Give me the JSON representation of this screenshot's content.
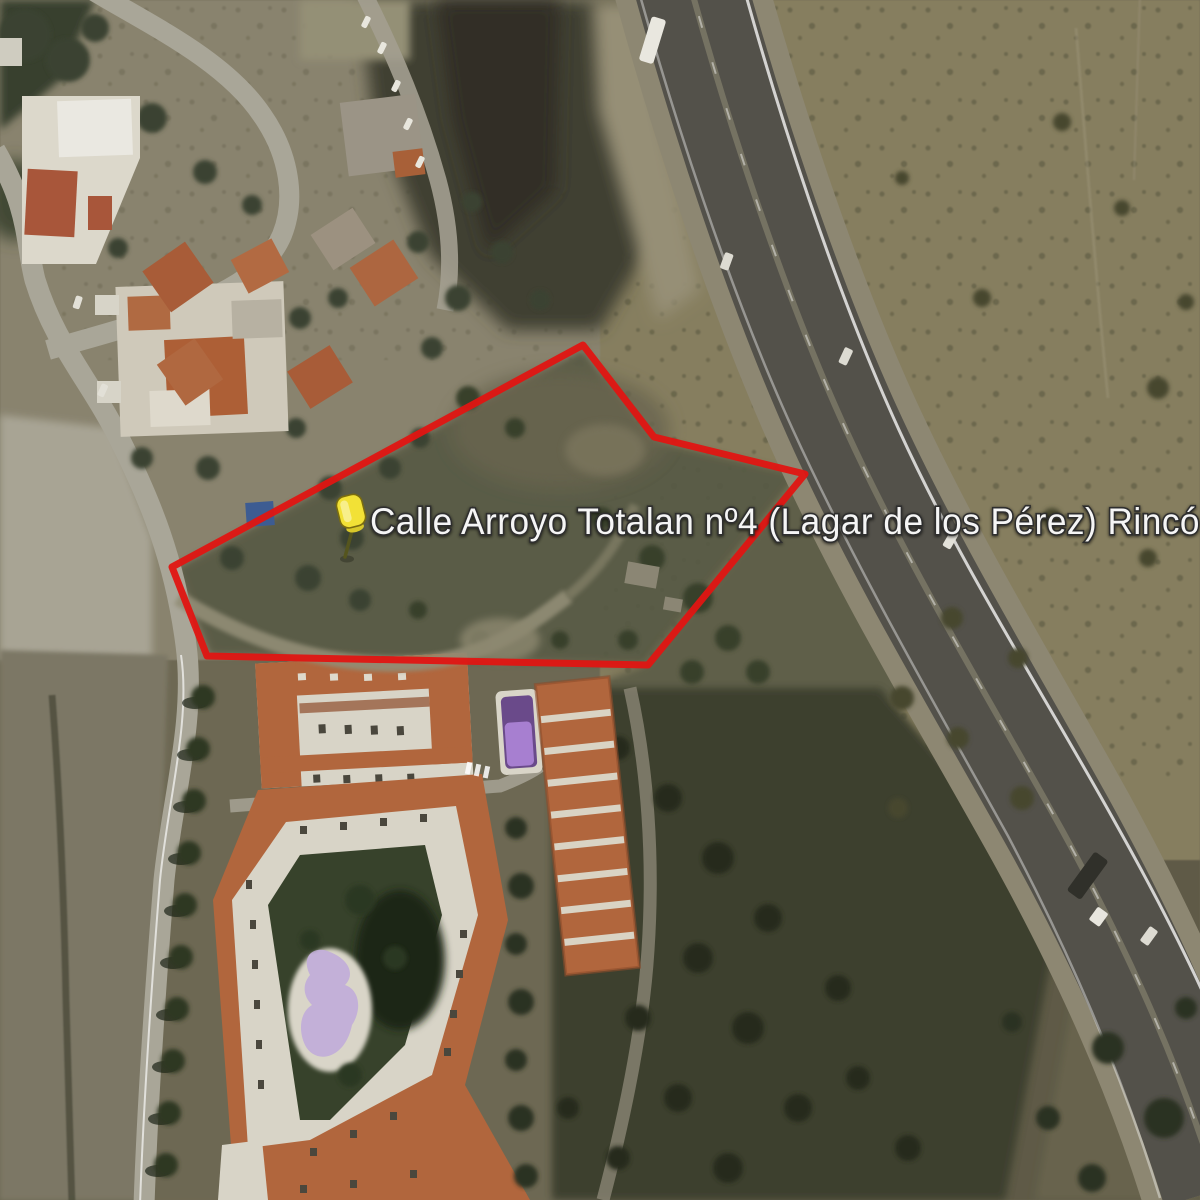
{
  "view": {
    "type": "satellite-imagery",
    "width_px": 1200,
    "height_px": 1200
  },
  "place_label": {
    "text": "Calle Arroyo Totalan nº4 (Lagar de los Pérez) Rincó",
    "color": "#f5f5f5",
    "font_px": 37,
    "truncated_at_right_edge": true
  },
  "marker": {
    "icon": "pushpin-icon",
    "color": "#f2e136",
    "outline_color": "#7a6c10",
    "head_x": 352,
    "head_y": 515,
    "tip_x": 344,
    "tip_y": 558
  },
  "boundary": {
    "shape": "polygon",
    "color": "#e01512",
    "stroke_px": 7,
    "points": "583,345 654,437 805,474 648,665 207,656 172,567"
  },
  "scene_features": [
    "highway-dual-carriageway",
    "arid-scrubland-east",
    "residential-hillside-northwest",
    "outlined-vacant-parcel",
    "apartment-complex-pentagon-courtyard",
    "apartment-row-blocks",
    "swimming-pools",
    "tree-lined-street"
  ],
  "palette": {
    "terrain_base": "#6d6853",
    "arid_field": "#867e5f",
    "asphalt": "#53514a",
    "local_road": "#a8a497",
    "terracotta_roof": "#b1663d",
    "white_building": "#d9d5c8",
    "dark_tree": "#2c3421",
    "pool_purple": "#b7a3d4",
    "pool_blue": "#3d5c92"
  }
}
